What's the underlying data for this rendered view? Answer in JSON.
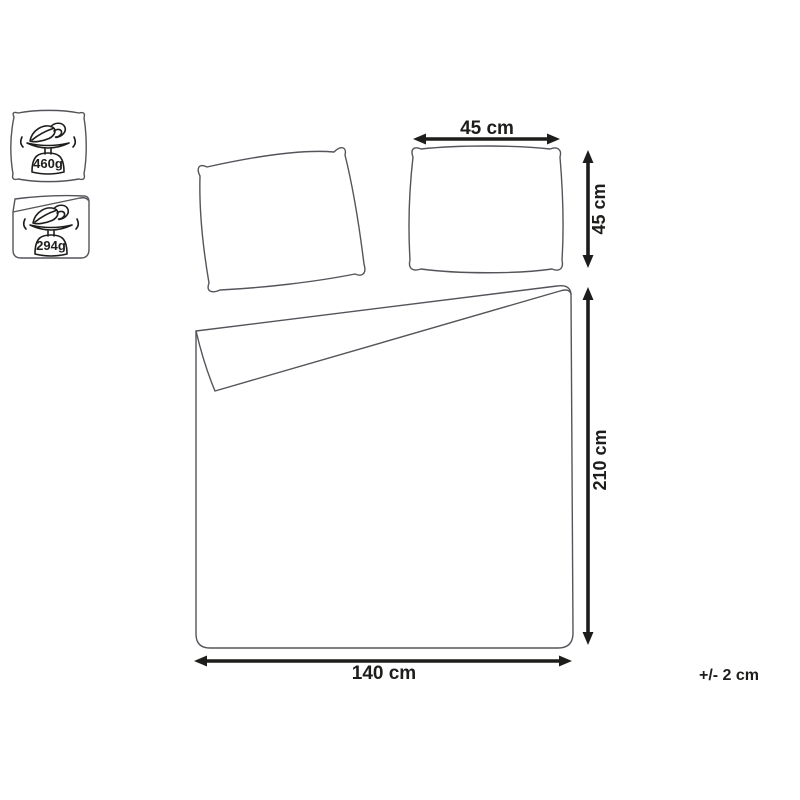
{
  "diagram": {
    "weights": {
      "pillow": "460g",
      "duvet": "294g"
    },
    "labels": {
      "pillow_width": "45 cm",
      "pillow_height": "45 cm",
      "duvet_length": "210 cm",
      "duvet_width": "140 cm",
      "tolerance": "+/- 2 cm"
    },
    "colors": {
      "background": "#ffffff",
      "outline": "#54545a",
      "ink": "#1d1d1b"
    },
    "icons": {
      "pillow_weight_badge": "feather-scale-icon",
      "duvet_weight_badge": "feather-scale-icon"
    }
  }
}
